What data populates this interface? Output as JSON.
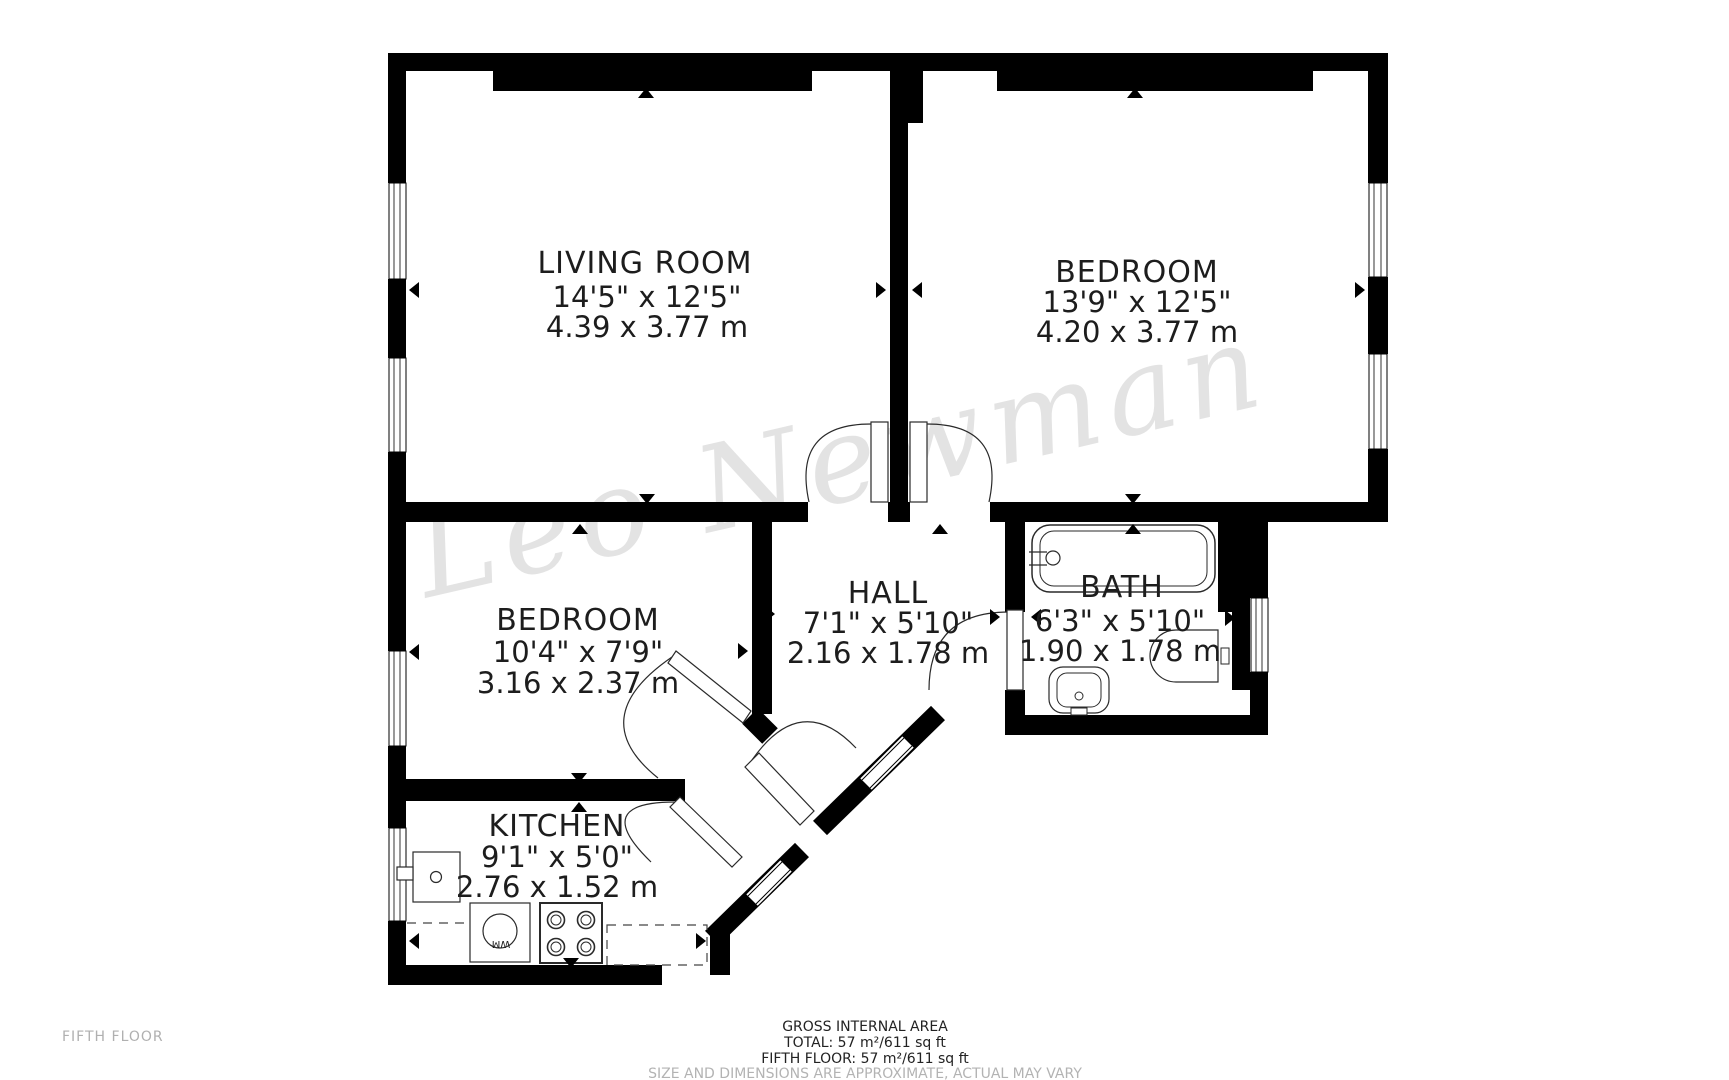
{
  "floorplan": {
    "watermark": "Leo Newman",
    "floor_label": "FIFTH FLOOR",
    "rooms": [
      {
        "name": "LIVING ROOM",
        "imperial": "14'5\" x 12'5\"",
        "metric": "4.39 x 3.77 m"
      },
      {
        "name": "BEDROOM",
        "imperial": "13'9\" x 12'5\"",
        "metric": "4.20 x 3.77 m"
      },
      {
        "name": "BEDROOM",
        "imperial": "10'4\" x 7'9\"",
        "metric": "3.16 x 2.37 m"
      },
      {
        "name": "HALL",
        "imperial": "7'1\" x 5'10\"",
        "metric": "2.16 x 1.78 m"
      },
      {
        "name": "BATH",
        "imperial": "6'3\" x 5'10\"",
        "metric": "1.90 x 1.78 m"
      },
      {
        "name": "KITCHEN",
        "imperial": "9'1\" x 5'0\"",
        "metric": "2.76 x 1.52 m"
      }
    ],
    "appliances": {
      "washing_machine_label": "WM"
    },
    "footer": {
      "area_title": "GROSS INTERNAL AREA",
      "total": "TOTAL: 57 m²/611 sq ft",
      "floor_total": "FIFTH FLOOR: 57 m²/611 sq ft",
      "disclaimer": "SIZE AND DIMENSIONS ARE APPROXIMATE, ACTUAL MAY VARY"
    },
    "colors": {
      "wall": "#000000",
      "watermark": "#e3e3e3",
      "muted": "#b3b3b3",
      "text": "#1d1d1d"
    }
  }
}
